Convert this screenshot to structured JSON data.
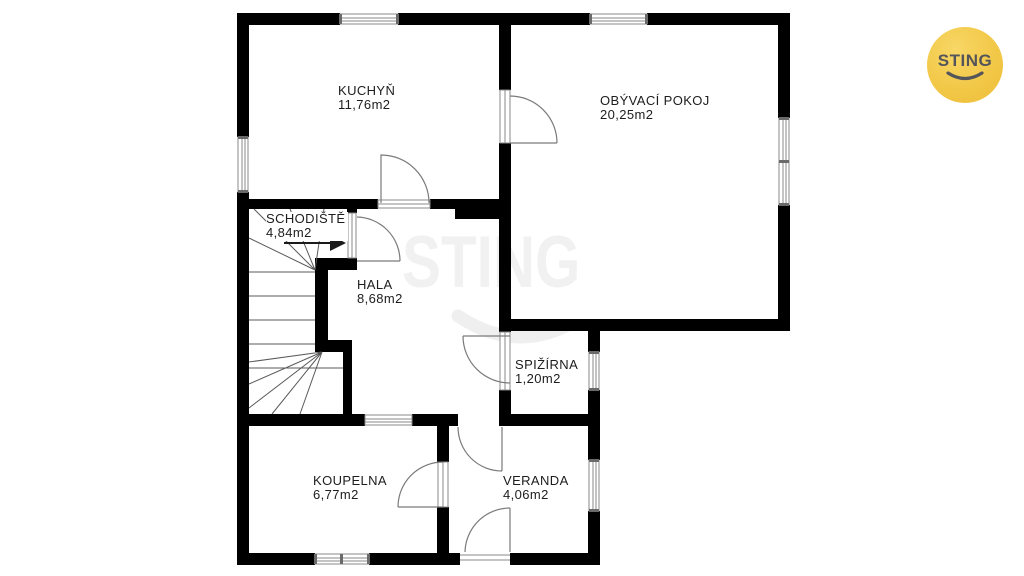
{
  "watermark": {
    "text": "STING"
  },
  "logo": {
    "text": "STING",
    "bg_color": "#f2c848",
    "text_color": "#54555a"
  },
  "floorplan": {
    "rooms": [
      {
        "key": "kuchyn",
        "name": "KUCHYŇ",
        "area": "11,76m2"
      },
      {
        "key": "obyvaci-pokoj",
        "name": "OBÝVACÍ POKOJ",
        "area": "20,25m2"
      },
      {
        "key": "schodiste",
        "name": "SCHODIŠTĚ",
        "area": "4,84m2"
      },
      {
        "key": "hala",
        "name": "HALA",
        "area": "8,68m2"
      },
      {
        "key": "spizirna",
        "name": "SPIŽÍRNA",
        "area": "1,20m2"
      },
      {
        "key": "koupelna",
        "name": "KOUPELNA",
        "area": "6,77m2"
      },
      {
        "key": "veranda",
        "name": "VERANDA",
        "area": "4,06m2"
      }
    ],
    "colors": {
      "wall": "#000000",
      "door_line": "#7a7a7a",
      "stair_line": "#5a5a5a",
      "window_frame": "#8a8a8a",
      "window_fill": "#ffffff",
      "label_text": "#1d1d1d",
      "watermark": "#f1f1f1",
      "logo_yellow": "#f2c848"
    }
  }
}
